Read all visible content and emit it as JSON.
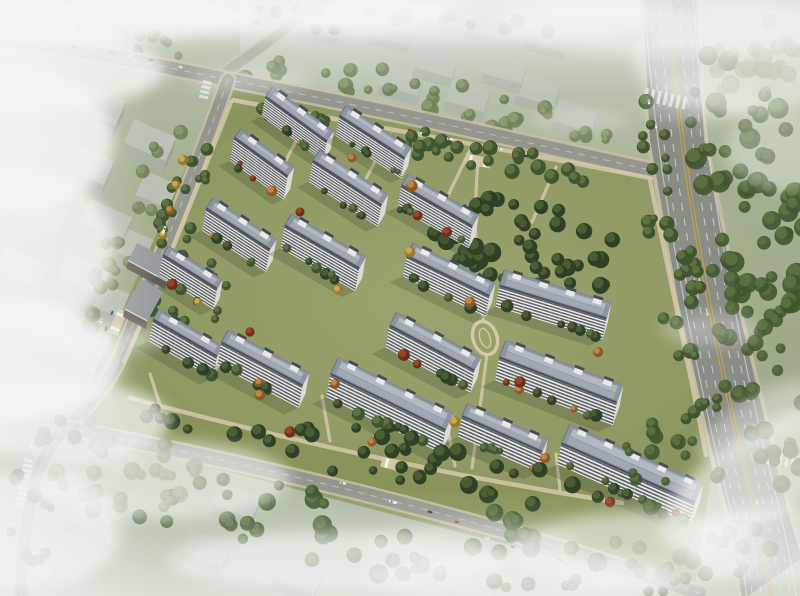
{
  "scene": {
    "title": "residential-complex-aerial-rendering",
    "width": 800,
    "height": 596,
    "description": "Bird's-eye architectural rendering of a residential compound: rows of white slab apartment buildings with slate-blue roofs and rooftop stair bulkheads, green courtyards, tan walking paths, an oval garden feature, bounded by tree-lined city streets with cars and buses, a wide multi-lane arterial road on the right with lane markings and crosswalks, hazy low-rise context blocks to the left/top/bottom, and drifting white fog."
  },
  "palette": {
    "bg_top": "#c9d1c9",
    "bg_mid": "#a7b294",
    "bg_low": "#9aa685",
    "bg_bottom": "#bfc8b8",
    "ctx_ground": "#a3b08f",
    "compound_ground": "#8b955f",
    "lawn_light": "#9aa46b",
    "lawn_glow": "#b8bf8a",
    "road": "#95978f",
    "arterial": "#8a8c86",
    "sidewalk": "#c7bda6",
    "path_tan": "#d5c8aa",
    "lane_white": "#e2e4e0",
    "lane_yellow": "#c9a63e",
    "tree_dark_base": "#2f4026",
    "tree_dark_top": "#4a5e35",
    "tree_mid_base": "#3f5530",
    "tree_mid_top": "#5d7240",
    "tree_pale_base": "#6b7d55",
    "tree_pale_top": "#8a9a6d",
    "autumn_orange": "#c08544",
    "autumn_orange_b": "#8a5a28",
    "autumn_yellow": "#cfa84e",
    "autumn_yellow_b": "#9a7a30",
    "autumn_red": "#9c4429",
    "autumn_red_b": "#6e2f1d",
    "bld_wall": "#efeee5",
    "bld_wall_dark": "#d8d4c6",
    "bld_window": "#39414e",
    "bld_end": "#dcdcd4",
    "roof_base": "#8d95a3",
    "roof_panel": "#b2b8c1",
    "roof_panel2": "#a4abb6",
    "roof_edge": "#4b525e",
    "bulkhead": "#e9eae8",
    "bulkhead_cap": "#474d56",
    "ctx_top": "#c2c6c2",
    "ctx_front": "#a9aeaa",
    "ctx_side": "#979d99",
    "podium_roof": "#9a9da0",
    "podium_front": "#6e6862",
    "fog": "#f4f6f3",
    "shadow": "#2e3a25",
    "veh_w": "#ecedea",
    "veh_d": "#3a4046",
    "veh_r": "#a33b2f",
    "veh_b": "#3c5288"
  },
  "buildings": [
    [
      296,
      119,
      76,
      36,
      8
    ],
    [
      372,
      137,
      78,
      33,
      8
    ],
    [
      261,
      157,
      66,
      36,
      9
    ],
    [
      347,
      183,
      82,
      33,
      8
    ],
    [
      437,
      206,
      82,
      30,
      8
    ],
    [
      238,
      229,
      76,
      33,
      8
    ],
    [
      322,
      247,
      86,
      30,
      8
    ],
    [
      448,
      276,
      92,
      26,
      7
    ],
    [
      553,
      302,
      112,
      17,
      7
    ],
    [
      190,
      272,
      64,
      32,
      7
    ],
    [
      185,
      338,
      74,
      30,
      7
    ],
    [
      262,
      364,
      92,
      28,
      7
    ],
    [
      432,
      348,
      96,
      28,
      7
    ],
    [
      388,
      402,
      128,
      26,
      7
    ],
    [
      558,
      380,
      126,
      21,
      7
    ],
    [
      502,
      434,
      88,
      24,
      6
    ],
    [
      628,
      473,
      146,
      24,
      6
    ]
  ],
  "podium": [
    [
      152,
      262,
      44,
      20,
      28
    ],
    [
      144,
      300,
      26,
      34,
      28
    ]
  ],
  "context_clusters": [
    {
      "rot": 24,
      "w": 46,
      "d": 26,
      "h": 13,
      "opacity": 0.72,
      "boxes": [
        [
          38,
          80
        ],
        [
          100,
          104
        ],
        [
          24,
          142
        ],
        [
          88,
          164
        ],
        [
          150,
          140
        ],
        [
          42,
          214
        ],
        [
          106,
          220
        ],
        [
          162,
          192
        ],
        [
          22,
          268
        ],
        [
          84,
          274
        ],
        [
          144,
          250
        ],
        [
          58,
          324
        ],
        [
          120,
          304
        ],
        [
          30,
          372
        ],
        [
          92,
          360
        ]
      ]
    },
    {
      "rot": 16,
      "w": 40,
      "d": 22,
      "h": 10,
      "opacity": 0.5,
      "boxes": [
        [
          402,
          80
        ],
        [
          468,
          96
        ],
        [
          538,
          90
        ],
        [
          576,
          116
        ],
        [
          505,
          68
        ],
        [
          436,
          62
        ]
      ]
    },
    {
      "rot": 14,
      "w": 42,
      "d": 22,
      "h": 8,
      "opacity": 0.32,
      "boxes": [
        [
          30,
          26
        ],
        [
          118,
          20
        ],
        [
          320,
          22
        ],
        [
          392,
          30
        ],
        [
          464,
          18
        ],
        [
          548,
          36
        ]
      ]
    },
    {
      "rot": 22,
      "w": 44,
      "d": 24,
      "h": 11,
      "opacity": 0.52,
      "boxes": [
        [
          122,
          462
        ],
        [
          90,
          516
        ],
        [
          206,
          548
        ],
        [
          298,
          576
        ],
        [
          236,
          500
        ],
        [
          420,
          560
        ],
        [
          472,
          588
        ],
        [
          34,
          560
        ]
      ]
    }
  ],
  "roads": {
    "main_street": {
      "path": "M -8,38 C 120,55 205,76 240,82 C 400,113 560,150 655,171",
      "width": 13
    },
    "left_street": {
      "path": "M 228,80 C 196,170 156,268 122,352 C 108,386 84,410 66,428 C 44,450 32,480 26,530 C 22,560 20,580 22,600",
      "width": 12
    },
    "bottom_road": {
      "path": "M 66,428 C 250,463 430,508 565,549 C 615,564 655,579 700,593",
      "width": 13
    },
    "north_branch": {
      "path": "M 218,78 L 336,-8",
      "width": 10
    },
    "arterial": {
      "west": [
        [
          643,
          -5
        ],
        [
          650,
          140
        ],
        [
          678,
          300
        ],
        [
          712,
          450
        ],
        [
          730,
          520
        ],
        [
          742,
          600
        ]
      ],
      "east": [
        [
          696,
          -5
        ],
        [
          704,
          140
        ],
        [
          736,
          300
        ],
        [
          772,
          450
        ],
        [
          790,
          520
        ],
        [
          802,
          558
        ]
      ],
      "center": "M 669,-5 C 676,140 706,300 740,450 C 757,515 766,555 772,600"
    }
  },
  "inner_paths": [
    "M 233,100 C 380,128 520,152 650,178",
    "M 231,102 C 196,190 162,278 124,362",
    "M 130,398 Q 380,465 622,503",
    "M 650,180 C 668,270 688,360 706,455",
    "M 308,118 L 282,168",
    "M 390,134 L 362,186",
    "M 470,150 L 444,204",
    "M 556,167 L 532,222",
    "M 478,162 C 472,230 478,300 484,322",
    "M 487,354 L 472,468",
    "M 330,441 L 322,396",
    "M 455,466 L 448,430",
    "M 560,490 L 556,454",
    "M 160,405 L 150,374"
  ],
  "oval": {
    "x": 485,
    "y": 338,
    "rx": 12,
    "ry": 17,
    "rot": -18
  },
  "gates": [
    [
      478,
      161,
      12
    ],
    [
      118,
      322,
      -68
    ],
    [
      394,
      465,
      14
    ]
  ],
  "tree_zones": [
    {
      "cx": 430,
      "cy": 100,
      "rx": 205,
      "ry": 24,
      "rot": 10,
      "n": 40,
      "pal": "pale",
      "op": 0.9,
      "rmin": 4,
      "rmax": 8
    },
    {
      "cx": 440,
      "cy": 148,
      "rx": 200,
      "ry": 14,
      "rot": 11,
      "n": 34,
      "pal": "mid",
      "op": 1,
      "rmin": 4,
      "rmax": 8
    },
    {
      "cx": 175,
      "cy": 225,
      "rx": 20,
      "ry": 115,
      "rot": 22,
      "n": 26,
      "pal": "mid",
      "op": 1,
      "rmin": 4,
      "rmax": 7
    },
    {
      "cx": 135,
      "cy": 225,
      "rx": 22,
      "ry": 115,
      "rot": 22,
      "n": 24,
      "pal": "pale",
      "op": 0.85,
      "rmin": 4,
      "rmax": 8
    },
    {
      "cx": 530,
      "cy": 245,
      "rx": 100,
      "ry": 42,
      "rot": 13,
      "n": 48,
      "pal": "dark",
      "op": 1,
      "rmin": 5,
      "rmax": 10
    },
    {
      "cx": 680,
      "cy": 290,
      "rx": 22,
      "ry": 200,
      "rot": -10,
      "n": 42,
      "pal": "mid",
      "op": 1,
      "rmin": 4,
      "rmax": 8
    },
    {
      "cx": 745,
      "cy": 190,
      "rx": 55,
      "ry": 150,
      "rot": -10,
      "n": 55,
      "pal": "mid",
      "op": 0.9,
      "rmin": 5,
      "rmax": 11
    },
    {
      "cx": 762,
      "cy": 380,
      "rx": 40,
      "ry": 110,
      "rot": -12,
      "n": 35,
      "pal": "mid",
      "op": 0.85,
      "rmin": 5,
      "rmax": 10
    },
    {
      "cx": 390,
      "cy": 535,
      "rx": 310,
      "ry": 42,
      "rot": 9,
      "n": 55,
      "pal": "mid",
      "op": 0.95,
      "rmin": 5,
      "rmax": 10
    },
    {
      "cx": 370,
      "cy": 455,
      "rx": 240,
      "ry": 26,
      "rot": 11,
      "n": 38,
      "pal": "dark",
      "op": 1,
      "rmin": 4,
      "rmax": 9
    },
    {
      "cx": 115,
      "cy": 468,
      "rx": 85,
      "ry": 50,
      "rot": 0,
      "n": 26,
      "pal": "pale",
      "op": 0.8,
      "rmin": 5,
      "rmax": 9
    },
    {
      "cx": 742,
      "cy": 55,
      "rx": 65,
      "ry": 42,
      "rot": 0,
      "n": 22,
      "pal": "pale",
      "op": 0.6,
      "rmin": 5,
      "rmax": 10
    },
    {
      "cx": 695,
      "cy": 545,
      "rx": 80,
      "ry": 38,
      "rot": 0,
      "n": 20,
      "pal": "mid",
      "op": 0.8,
      "rmin": 5,
      "rmax": 9
    },
    {
      "cx": 105,
      "cy": 38,
      "rx": 110,
      "ry": 16,
      "rot": 8,
      "n": 20,
      "pal": "pale",
      "op": 0.7,
      "rmin": 4,
      "rmax": 7
    },
    {
      "cx": 300,
      "cy": 18,
      "rx": 290,
      "ry": 14,
      "rot": 3,
      "n": 30,
      "pal": "pale",
      "op": 0.5,
      "rmin": 4,
      "rmax": 8
    },
    {
      "cx": 655,
      "cy": 465,
      "rx": 40,
      "ry": 55,
      "rot": 0,
      "n": 14,
      "pal": "mid",
      "op": 0.9,
      "rmin": 4,
      "rmax": 8
    },
    {
      "cx": 200,
      "cy": 300,
      "rx": 25,
      "ry": 40,
      "rot": 20,
      "n": 12,
      "pal": "mid",
      "op": 1,
      "rmin": 3,
      "rmax": 6
    },
    {
      "cx": 42,
      "cy": 480,
      "rx": 30,
      "ry": 90,
      "rot": 10,
      "n": 18,
      "pal": "mid",
      "op": 0.85,
      "rmin": 4,
      "rmax": 8
    }
  ],
  "accent_trees": [
    [
      352,
      158,
      "o"
    ],
    [
      300,
      212,
      "r"
    ],
    [
      410,
      252,
      "y"
    ],
    [
      470,
      302,
      "o"
    ],
    [
      250,
      332,
      "r"
    ],
    [
      335,
      384,
      "o"
    ],
    [
      455,
      422,
      "y"
    ],
    [
      545,
      458,
      "o"
    ],
    [
      610,
      502,
      "r"
    ],
    [
      198,
      302,
      "y"
    ],
    [
      290,
      432,
      "r"
    ],
    [
      372,
      442,
      "o"
    ],
    [
      520,
      382,
      "r"
    ],
    [
      598,
      352,
      "o"
    ],
    [
      447,
      232,
      "r"
    ],
    [
      412,
      186,
      "o"
    ],
    [
      338,
      290,
      "y"
    ],
    [
      260,
      395,
      "o"
    ],
    [
      183,
      160,
      "y"
    ],
    [
      176,
      185,
      "y"
    ],
    [
      170,
      210,
      "o"
    ],
    [
      163,
      235,
      "y"
    ]
  ],
  "vehicles": [
    [
      55,
      44,
      8,
      "w"
    ],
    [
      74,
      47,
      8,
      "d"
    ],
    [
      93,
      50,
      8,
      "w"
    ],
    [
      112,
      53,
      9,
      "r"
    ],
    [
      129,
      56,
      9,
      "w"
    ],
    [
      151,
      60,
      9,
      "d"
    ],
    [
      180,
      67,
      10,
      "w"
    ],
    [
      410,
      130,
      12,
      "r"
    ],
    [
      420,
      133,
      12,
      "w"
    ],
    [
      450,
      139,
      12,
      "van"
    ],
    [
      459,
      142,
      12,
      "r"
    ],
    [
      500,
      149,
      13,
      "w"
    ],
    [
      526,
      156,
      13,
      "d"
    ],
    [
      164,
      230,
      112,
      "bus"
    ],
    [
      112,
      313,
      112,
      "b"
    ],
    [
      101,
      321,
      112,
      "w"
    ],
    [
      106,
      329,
      112,
      "d"
    ],
    [
      90,
      405,
      130,
      "b"
    ],
    [
      32,
      445,
      100,
      "bus"
    ],
    [
      343,
      483,
      14,
      "van"
    ],
    [
      393,
      502,
      14,
      "bus"
    ],
    [
      430,
      512,
      15,
      "d"
    ],
    [
      457,
      522,
      15,
      "r"
    ],
    [
      487,
      538,
      16,
      "w"
    ],
    [
      513,
      547,
      16,
      "d"
    ],
    [
      560,
      560,
      17,
      "r"
    ],
    [
      600,
      572,
      17,
      "w"
    ],
    [
      649,
      102,
      86,
      "w"
    ],
    [
      656,
      126,
      86,
      "w"
    ],
    [
      757,
      502,
      76,
      "w"
    ]
  ],
  "crosswalks": [
    {
      "x": 646,
      "y": 88,
      "rot": 12,
      "n": 7,
      "len": 13,
      "step": 6.5
    },
    {
      "x": 768,
      "y": 452,
      "rot": 8,
      "n": 6,
      "len": 12,
      "step": 6
    },
    {
      "x": 212,
      "y": 82,
      "rot": 104,
      "n": 4,
      "len": 9,
      "step": 5
    },
    {
      "x": 33,
      "y": 460,
      "rot": 100,
      "n": 4,
      "len": 9,
      "step": 5
    },
    {
      "x": 28,
      "y": 488,
      "rot": 100,
      "n": 4,
      "len": 9,
      "step": 5
    }
  ],
  "arrow_marks": [
    [
      694,
      252,
      80
    ],
    [
      700,
      282,
      80
    ],
    [
      707,
      312,
      79
    ]
  ],
  "fog": [
    [
      80,
      16,
      180,
      26,
      0.9,
      0
    ],
    [
      270,
      12,
      190,
      24,
      0.75,
      0
    ],
    [
      480,
      16,
      200,
      26,
      0.6,
      0
    ],
    [
      670,
      24,
      170,
      32,
      0.55,
      0
    ],
    [
      35,
      70,
      130,
      40,
      0.8,
      0
    ],
    [
      18,
      140,
      95,
      70,
      0.85,
      0
    ],
    [
      25,
      250,
      90,
      80,
      0.8,
      0
    ],
    [
      12,
      360,
      110,
      60,
      0.85,
      0
    ],
    [
      90,
      340,
      70,
      14,
      0.5,
      0
    ],
    [
      60,
      420,
      110,
      40,
      0.75,
      0
    ],
    [
      160,
      480,
      130,
      40,
      0.6,
      0
    ],
    [
      340,
      562,
      170,
      30,
      0.6,
      0
    ],
    [
      520,
      578,
      160,
      26,
      0.6,
      0
    ],
    [
      640,
      552,
      130,
      40,
      0.55,
      0
    ],
    [
      470,
      545,
      110,
      22,
      0.4,
      0
    ],
    [
      755,
      480,
      110,
      45,
      0.65,
      -35
    ],
    [
      775,
      545,
      90,
      40,
      0.6,
      0
    ],
    [
      760,
      420,
      70,
      24,
      0.4,
      -30
    ],
    [
      710,
      330,
      50,
      16,
      0.3,
      0
    ],
    [
      745,
      60,
      110,
      55,
      0.6,
      0
    ],
    [
      785,
      150,
      60,
      40,
      0.38,
      0
    ],
    [
      700,
      100,
      60,
      25,
      0.3,
      0
    ],
    [
      250,
      80,
      60,
      14,
      0.3,
      0
    ],
    [
      580,
      120,
      50,
      12,
      0.25,
      0
    ],
    [
      30,
      530,
      90,
      60,
      0.7,
      0
    ]
  ]
}
